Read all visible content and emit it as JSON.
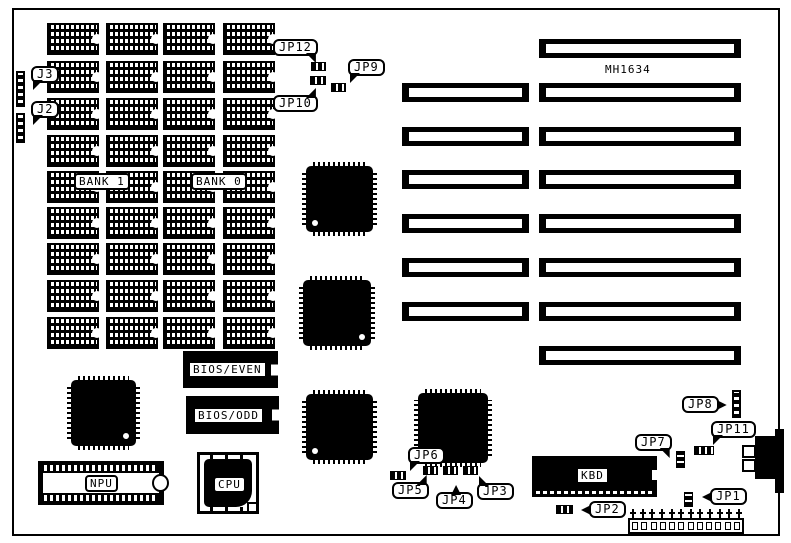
{
  "diagram": {
    "board_model": "MH1634",
    "type": "motherboard-layout"
  },
  "memory": {
    "rows": 9,
    "cols": 4,
    "bank1_label": "BANK 1",
    "bank0_label": "BANK 0"
  },
  "slots": {
    "count": 8,
    "short_segment_rows": [
      1,
      2,
      3,
      4,
      5,
      6
    ]
  },
  "chips": {
    "bios_even": "BIOS/EVEN",
    "bios_odd": "BIOS/ODD",
    "npu": "NPU",
    "cpu": "CPU",
    "kbd": "KBD"
  },
  "callouts": {
    "j3": "J3",
    "j2": "J2",
    "jp12": "JP12",
    "jp10": "JP10",
    "jp9": "JP9",
    "jp6": "JP6",
    "jp5": "JP5",
    "jp4": "JP4",
    "jp3": "JP3",
    "jp7": "JP7",
    "jp8": "JP8",
    "jp11": "JP11",
    "jp1": "JP1",
    "jp2": "JP2"
  },
  "terminal": {
    "pin_count": 12,
    "cell_count": 12
  }
}
